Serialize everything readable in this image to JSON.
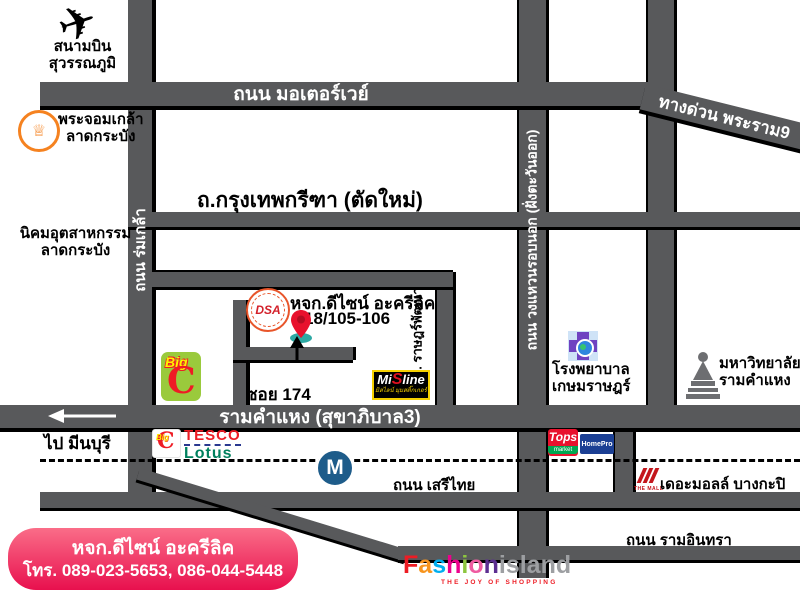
{
  "colors": {
    "road": "#58595b",
    "contact_box_pink": "#e8104e",
    "bigc_green": "#9aca3c",
    "bigc_red": "#ee1c25",
    "tesco_red": "#ee1c25",
    "lotus_green": "#00805e",
    "tops_red": "#e8112d",
    "homepro_navy": "#1b3f94",
    "metro_blue": "#1e5c8a",
    "hospital_purple": "#6f42c1",
    "kmitl_orange": "#f58220",
    "mall_red": "#c4161c",
    "pin_red": "#e8112d",
    "pin_base_teal": "#2ea9a4"
  },
  "airport": {
    "icon": "airplane-icon",
    "line1": "สนามบิน",
    "line2": "สุวรรณภูมิ"
  },
  "roads": {
    "motorway": "ถนน มอเตอร์เวย์",
    "expressway": "ทางด่วน พระราม9",
    "romklao": "ถนน ร่มเกล้า",
    "outer_ring": "ถนน วงแหวนรอบนอก (ฝั่งตะวันออก)",
    "krungthep_kreetha": "ถ.กรุงเทพกรีฑา (ตัดใหม่)",
    "ratpattana": "ถ. ราษฎร์พัฒนา",
    "soi": "ซอย 174",
    "ramkhamhaeng": "รามคำแหง (สุขาภิบาล3)",
    "to_minburi": "ไป มีนบุรี",
    "serithai": "ถนน เสรีไทย",
    "raminthra": "ถนน รามอินทรา"
  },
  "landmarks": {
    "kmitl": {
      "line1": "พระจอมเกล้า",
      "line2": "ลาดกระบัง"
    },
    "industrial_estate": {
      "line1": "นิคมอุตสาหกรรม",
      "line2": "ลาดกระบัง"
    },
    "shop": {
      "name": "หจก.ดีไซน์ อะครีลิค",
      "address": "18/105-106",
      "logo_text": "DSA"
    },
    "bigc": {
      "word": "Big",
      "letter": "C"
    },
    "misline": {
      "part1": "Mi",
      "s": "S",
      "part2": "line",
      "tagline": "มิสไลน์ มุมสติ๊กเกอร์"
    },
    "tesco": {
      "small_big": "Big",
      "small_c": "C",
      "line1": "TESCO",
      "line2": "Lotus"
    },
    "metro_m": "M",
    "tops": {
      "name": "Tops",
      "sub": "market"
    },
    "homepro": "HomePro",
    "hospital": {
      "line1": "โรงพยาบาล",
      "line2": "เกษมราษฎร์"
    },
    "university": {
      "line1": "มหาวิทยาลัย",
      "line2": "รามคำแหง"
    },
    "the_mall": {
      "logo_caption": "THE MALL",
      "name": "เดอะมอลล์ บางกะปิ"
    }
  },
  "fashion_island": {
    "letters": [
      {
        "ch": "F",
        "color": "#ed1c24"
      },
      {
        "ch": "a",
        "color": "#f7941d"
      },
      {
        "ch": "s",
        "color": "#00aeef"
      },
      {
        "ch": "h",
        "color": "#ec008c"
      },
      {
        "ch": "i",
        "color": "#8dc63f"
      },
      {
        "ch": "o",
        "color": "#ef5ba1"
      },
      {
        "ch": "n",
        "color": "#5c2e91"
      }
    ],
    "island": "island",
    "tagline": "THE JOY OF SHOPPING"
  },
  "contact": {
    "name": "หจก.ดีไซน์ อะครีลิค",
    "phone": "โทร. 089-023-5653, 086-044-5448"
  }
}
